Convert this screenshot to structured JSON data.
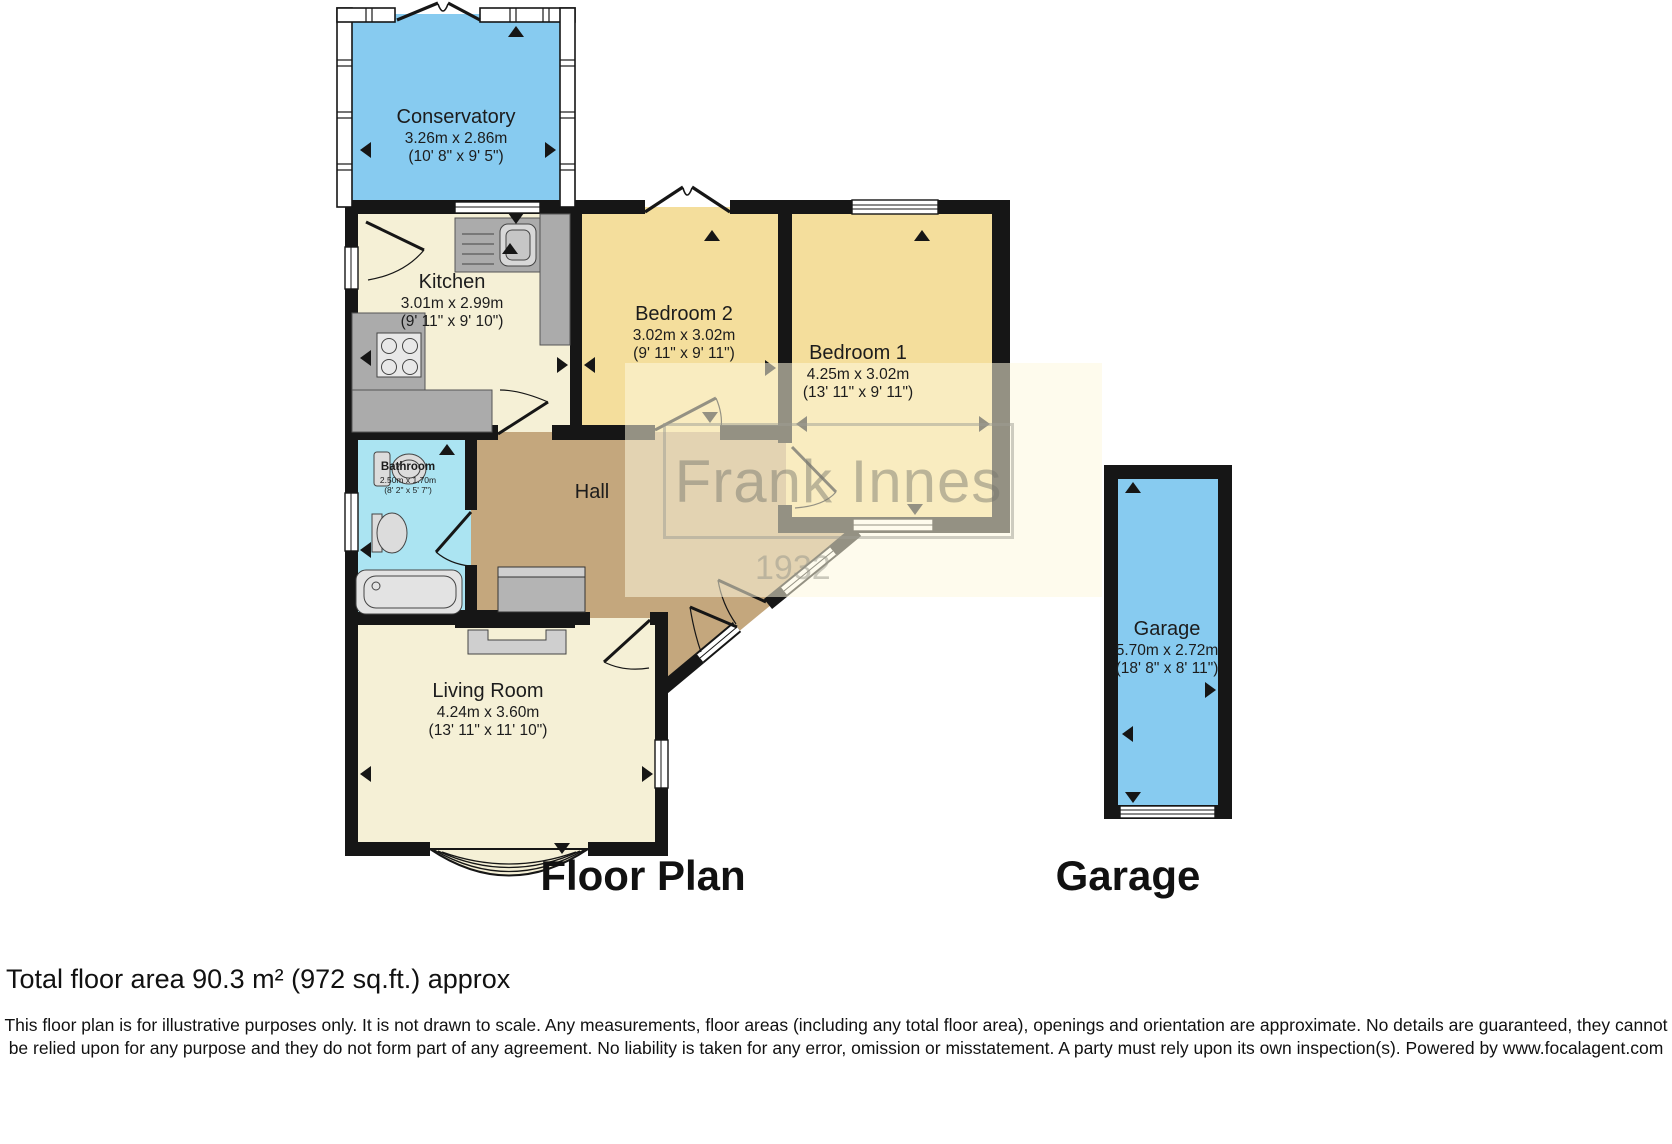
{
  "rooms": {
    "conservatory": {
      "name": "Conservatory",
      "metric": "3.26m x 2.86m",
      "imperial": "(10' 8\" x 9' 5\")"
    },
    "kitchen": {
      "name": "Kitchen",
      "metric": "3.01m x 2.99m",
      "imperial": "(9' 11\" x 9' 10\")"
    },
    "bedroom2": {
      "name": "Bedroom 2",
      "metric": "3.02m x 3.02m",
      "imperial": "(9' 11\" x 9' 11\")"
    },
    "bedroom1": {
      "name": "Bedroom 1",
      "metric": "4.25m x 3.02m",
      "imperial": "(13' 11\" x 9' 11\")"
    },
    "bathroom": {
      "name": "Bathroom",
      "metric": "2.50m x 1.70m",
      "imperial": "(8' 2\" x 5' 7\")"
    },
    "hall": {
      "name": "Hall"
    },
    "living_room": {
      "name": "Living Room",
      "metric": "4.24m x 3.60m",
      "imperial": "(13' 11\" x 11' 10\")"
    },
    "garage": {
      "name": "Garage",
      "metric": "5.70m x 2.72m",
      "imperial": "(18' 8\" x 8' 11\")"
    }
  },
  "titles": {
    "floor_plan": "Floor Plan",
    "garage": "Garage"
  },
  "watermark": {
    "name": "Frank Innes",
    "year": "1932"
  },
  "footer": {
    "total_area": "Total floor area 90.3 m² (972 sq.ft.) approx",
    "disclaimer": "This floor plan is for illustrative purposes only. It is not drawn to scale. Any measurements, floor areas (including any total floor area), openings and orientation are approximate. No details are guaranteed, they cannot be relied upon for any purpose and they do not form part of any agreement. No liability is taken for any error, omission or misstatement. A party must rely upon its own inspection(s). Powered by www.focalagent.com"
  },
  "colors": {
    "wall": "#161616",
    "conservatory_fill": "#87CBF0",
    "garage_fill": "#87CBF0",
    "bathroom_fill": "#ABE4F2",
    "bedroom_fill": "#F4DE9C",
    "kitchen_fill": "#F5F0D6",
    "living_fill": "#F5F0D6",
    "hall_fill": "#C4A77D",
    "counter_gray": "#ABABAB",
    "fixture_gray": "#DCDCDC",
    "watermark_bg": "#FDF8DE"
  }
}
